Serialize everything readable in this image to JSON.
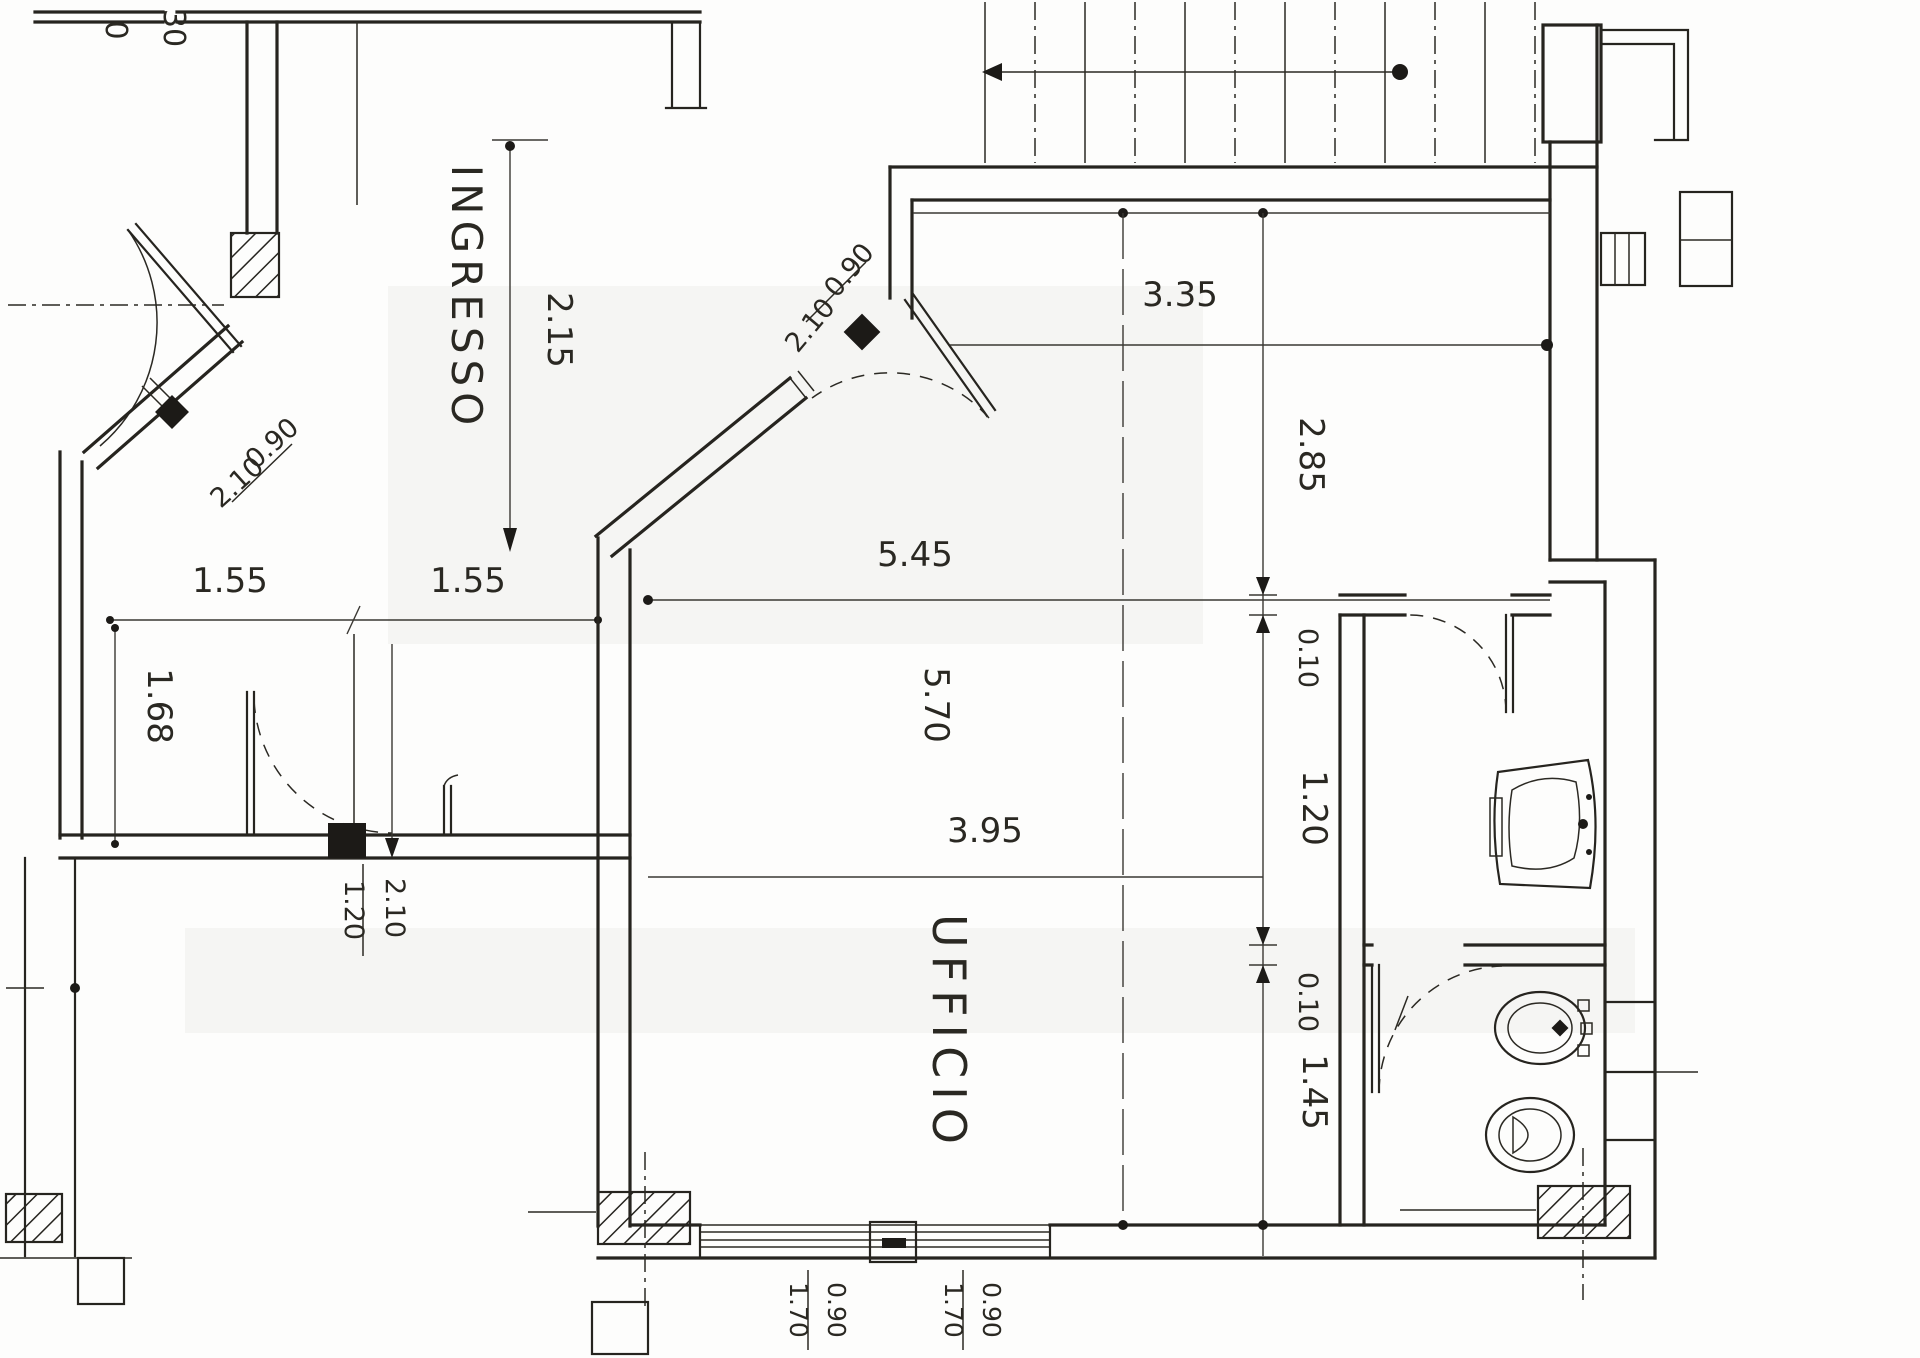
{
  "plan": {
    "labels": {
      "ingresso": "INGRESSO",
      "ufficio": "UFFICIO"
    },
    "dims": {
      "entry_length": "2.15",
      "top_width": "3.35",
      "upper_height": "2.85",
      "office_width": "5.45",
      "office_depth": "5.70",
      "office_lower_width": "3.95",
      "chain_wall_a": "0.10",
      "antibagno_depth": "1.20",
      "chain_wall_b": "0.10",
      "bagno_depth": "1.45",
      "corridor_a": "1.55",
      "corridor_b": "1.55",
      "corridor_depth": "1.68"
    },
    "doors": {
      "building": {
        "w": "0.90",
        "h": "2.10"
      },
      "office": {
        "w": "0.90",
        "h": "2.10"
      },
      "internal": {
        "w": "1.20",
        "h": "2.10"
      }
    },
    "windows": {
      "a": {
        "w": "0.90",
        "h": "1.70"
      },
      "b": {
        "w": "0.90",
        "h": "1.70"
      }
    },
    "fragments": {
      "a": "0",
      "b": "30"
    }
  }
}
